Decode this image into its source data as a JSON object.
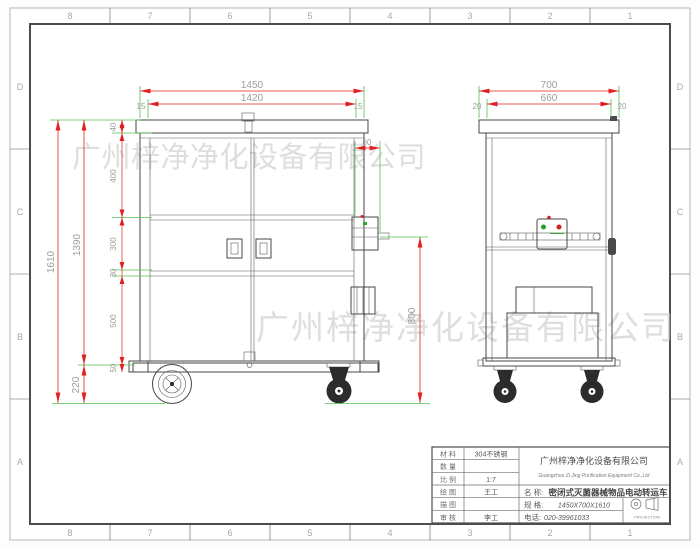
{
  "sheet": {
    "zones_h": [
      "8",
      "7",
      "6",
      "5",
      "4",
      "3",
      "2",
      "1"
    ],
    "zones_v": [
      "D",
      "C",
      "B",
      "A"
    ]
  },
  "watermark": {
    "text": "广州梓净净化设备有限公司"
  },
  "dims": {
    "w_outer": "1450",
    "w_inner": "1420",
    "w_edge": "15",
    "d_outer": "700",
    "d_inner": "660",
    "d_edge": "20",
    "h_total": "1610",
    "h_body": "1390",
    "h_caster": "220",
    "seg_lid": "40",
    "seg_upper": "400",
    "seg_mid": "300",
    "seg_rail": "30",
    "seg_lower": "500",
    "seg_base": "50",
    "box_w": "60",
    "bar_h": "800"
  },
  "title_block": {
    "rows": [
      {
        "label": "材 料",
        "value": "304不锈钢"
      },
      {
        "label": "数 量",
        "value": ""
      },
      {
        "label": "比 例",
        "value": "1:7"
      },
      {
        "label": "绘 图",
        "value": "王工"
      },
      {
        "label": "描 图",
        "value": ""
      },
      {
        "label": "审 核",
        "value": "李工"
      }
    ],
    "company_cn": "广州梓净净化设备有限公司",
    "company_en": "Guangzhou Zi Jing Purification Equipment Co.,Ltd",
    "name_label": "名 称:",
    "name_value": "密闭式灭菌器械物品电动转运车",
    "spec_label": "规 格:",
    "spec_value": "1450X700X1610",
    "phone_label": "电话:",
    "phone_value": "020-39961033",
    "projection_label": "PROJECTION"
  }
}
